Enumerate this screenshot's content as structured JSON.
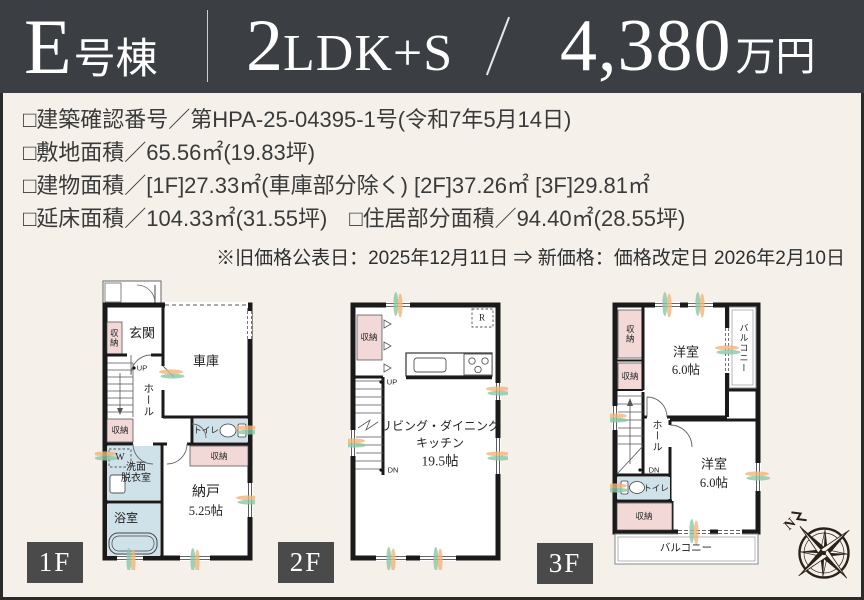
{
  "header": {
    "building_big": "E",
    "building_small": "号棟",
    "layout_big": "2",
    "layout_small": "LDK+S",
    "price_big": "4,380",
    "price_small": "万円"
  },
  "details": {
    "lines": [
      "□建築確認番号／第HPA-25-04395-1号(令和7年5月14日)",
      "□敷地面積／65.56㎡(19.83坪)",
      "□建物面積／[1F]27.33㎡(車庫部分除く) [2F]37.26㎡ [3F]29.81㎡",
      "□延床面積／104.33㎡(31.55坪)　□住居部分面積／94.40㎡(28.55坪)"
    ]
  },
  "notice": "※旧価格公表日：2025年12月11日 ⇒ 新価格：価格改定日 2026年2月10日",
  "plans": {
    "f1": {
      "tag": "1F",
      "genkan": "玄関",
      "closet1": "収納",
      "garage": "車庫",
      "up": "UP",
      "hall": "ホール",
      "closet2": "収納",
      "toilet": "トイレ",
      "washer": "W",
      "washroom_line1": "洗面",
      "washroom_line2": "脱衣室",
      "closet3": "収納",
      "storage_room": "納戸",
      "storage_size": "5.25帖",
      "bath": "浴室"
    },
    "f2": {
      "tag": "2F",
      "closet": "収納",
      "fridge": "R",
      "up": "UP",
      "down": "DN",
      "ldk_line1": "リビング・ダイニング",
      "ldk_line2": "キッチン",
      "ldk_size": "19.5帖"
    },
    "f3": {
      "tag": "3F",
      "closet1": "収納",
      "closet2": "収納",
      "room1": "洋室",
      "room1_size": "6.0帖",
      "balcony_side": "バルコニー",
      "hall": "ホール",
      "down": "DN",
      "toilet": "トイレ",
      "closet3": "収納",
      "room2": "洋室",
      "room2_size": "6.0帖",
      "balcony_bottom": "バルコニー"
    }
  },
  "compass": {
    "north": "N"
  },
  "colors": {
    "header_bg": "#3b3e43",
    "page_bg": "#f5f1ea",
    "wall": "#1a1a1a",
    "closet_pink": "#f2d9d7",
    "wet_area_blue": "#cfe2ea",
    "floor_tag_bg": "#4a4a4b",
    "accent_orange": "#f1b57c",
    "accent_green": "#8cc7a4",
    "compass_ink": "#2b211a"
  }
}
